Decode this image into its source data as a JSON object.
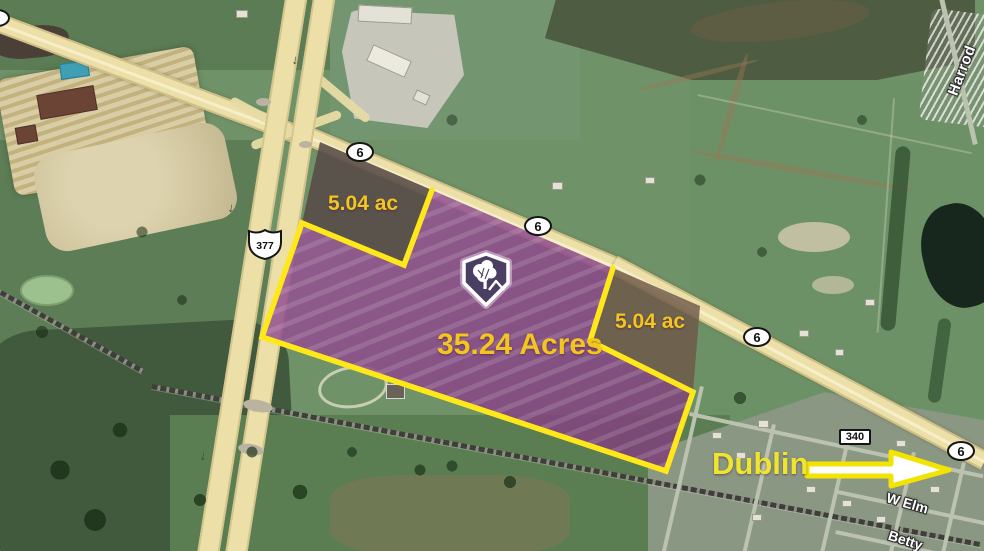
{
  "map_labels": {
    "acreage": "35.24 Acres",
    "notch_top": "5.04 ac",
    "notch_right": "5.04 ac",
    "town": "Dublin"
  },
  "street_labels": {
    "harrod": "Harrod",
    "w_elm": "W Elm",
    "betty": "Betty"
  },
  "route_shields": {
    "route_6": "6",
    "route_377": "377",
    "route_340": "340"
  },
  "icons": {
    "brand_marker": "tree-shield-logo-icon",
    "direction_arrow": "down-arrow",
    "town_pointer": "right-arrow"
  },
  "colors": {
    "parcel_fill": "#8D4A8C",
    "excluded_parcel_fill": "#5A4A48",
    "boundary_yellow": "#FFE81A",
    "label_gold": "#F4C41F",
    "town_label_yellow": "#EFE52F",
    "highway_tan": "#ECE0A8"
  }
}
